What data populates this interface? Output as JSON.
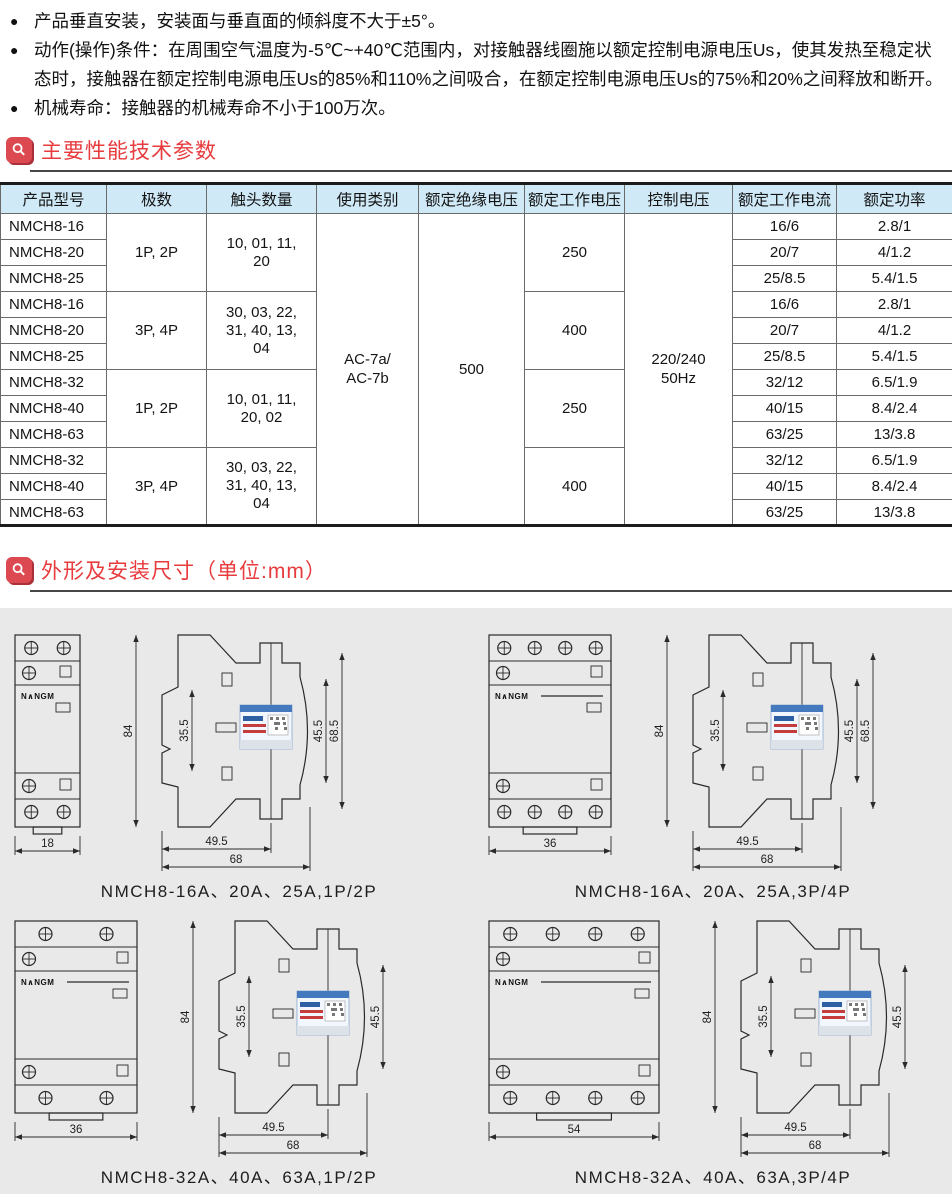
{
  "colors": {
    "accent_red": "#e73b3e",
    "section_icon_red": "#dd4950",
    "table_header_blue": "#cfe9f7",
    "panel_gray": "#e9e9e9"
  },
  "bullets": [
    "产品垂直安装，安装面与垂直面的倾斜度不大于±5°。",
    "动作(操作)条件：在周围空气温度为-5℃~+40℃范围内，对接触器线圈施以额定控制电源电压Us，使其发热至稳定状态时，接触器在额定控制电源电压Us的85%和110%之间吸合，在额定控制电源电压Us的75%和20%之间释放和断开。",
    "机械寿命：接触器的机械寿命不小于100万次。"
  ],
  "sections": {
    "performance": {
      "title": "主要性能技术参数"
    },
    "dimensions": {
      "title": "外形及安装尺寸（单位:mm）"
    }
  },
  "table": {
    "headers": [
      "产品型号",
      "极数",
      "触头数量",
      "使用类别",
      "额定绝缘电压",
      "额定工作电压",
      "控制电压",
      "额定工作电流",
      "额定功率"
    ],
    "models": [
      "NMCH8-16",
      "NMCH8-20",
      "NMCH8-25",
      "NMCH8-16",
      "NMCH8-20",
      "NMCH8-25",
      "NMCH8-32",
      "NMCH8-40",
      "NMCH8-63",
      "NMCH8-32",
      "NMCH8-40",
      "NMCH8-63"
    ],
    "poles": [
      "1P, 2P",
      "3P, 4P",
      "1P, 2P",
      "3P, 4P"
    ],
    "contacts": [
      "10, 01, 11, 20",
      "30, 03, 22, 31, 40, 13, 04",
      "10, 01, 11, 20, 02",
      "30, 03, 22, 31, 40, 13, 04"
    ],
    "category": "AC-7a/\nAC-7b",
    "insulation_voltage": "500",
    "working_voltage": [
      "250",
      "400",
      "250",
      "400"
    ],
    "control_voltage": "220/240\n50Hz",
    "currents": [
      "16/6",
      "20/7",
      "25/8.5",
      "16/6",
      "20/7",
      "25/8.5",
      "32/12",
      "40/15",
      "63/25",
      "32/12",
      "40/15",
      "63/25"
    ],
    "powers": [
      "2.8/1",
      "4/1.2",
      "5.4/1.5",
      "2.8/1",
      "4/1.2",
      "5.4/1.5",
      "6.5/1.9",
      "8.4/2.4",
      "13/3.8",
      "6.5/1.9",
      "8.4/2.4",
      "13/3.8"
    ]
  },
  "figures": [
    {
      "caption": "NMCH8-16A、20A、25A,1P/2P",
      "brand": "N∧NGM",
      "front_width_label": "18",
      "screws": 2,
      "fw": 65,
      "dims": {
        "height": "84",
        "notch": "35.5",
        "inner_right": "45.5",
        "outer_right": "68.5",
        "rail": "49.5",
        "depth": "68"
      }
    },
    {
      "caption": "NMCH8-16A、20A、25A,3P/4P",
      "brand": "N∧NGM",
      "front_width_label": "36",
      "screws": 4,
      "fw": 122,
      "dims": {
        "height": "84",
        "notch": "35.5",
        "inner_right": "45.5",
        "outer_right": "68.5",
        "rail": "49.5",
        "depth": "68"
      }
    },
    {
      "caption": "NMCH8-32A、40A、63A,1P/2P",
      "brand": "N∧NGM",
      "front_width_label": "36",
      "screws": 2,
      "fw": 122,
      "dims": {
        "height": "84",
        "notch": "35.5",
        "inner_right": "45.5",
        "rail": "49.5",
        "depth": "68"
      }
    },
    {
      "caption": "NMCH8-32A、40A、63A,3P/4P",
      "brand": "N∧NGM",
      "front_width_label": "54",
      "screws": 4,
      "fw": 170,
      "dims": {
        "height": "84",
        "notch": "35.5",
        "inner_right": "45.5",
        "rail": "49.5",
        "depth": "68"
      }
    }
  ]
}
